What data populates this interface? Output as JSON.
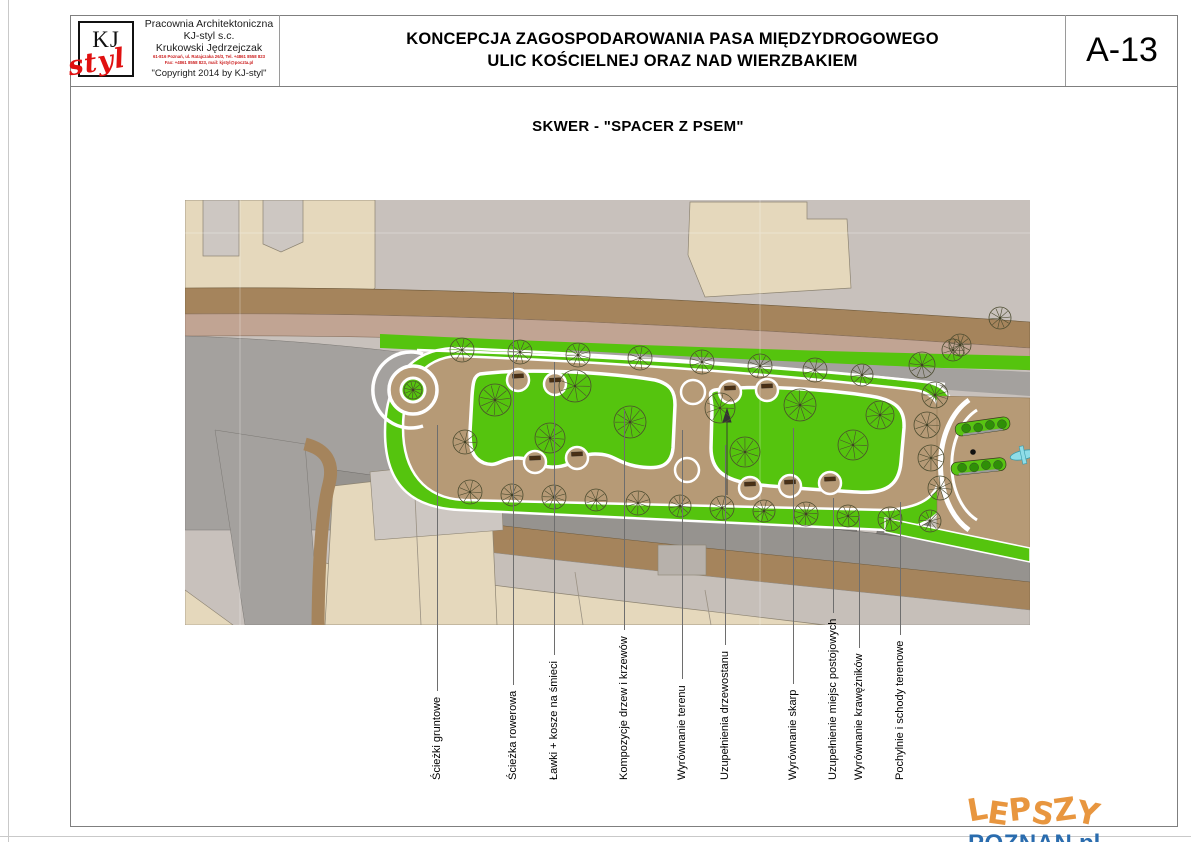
{
  "sheet": {
    "number": "A-13"
  },
  "title_block": {
    "logo_kj": "KJ",
    "logo_styl": "styl",
    "company_line1": "Pracownia Architektoniczna",
    "company_line2": "KJ-styl s.c.",
    "company_line3": "Krukowski Jędrzejczak",
    "address_line1": "61-816 Poznań, ul. Ratajczaka 26/3, Tel. +4861 8558 823",
    "address_line2": "Fax: +4861 8558 823, mail: kjstyl@poczta.pl",
    "copyright": "\"Copyright 2014 by KJ-styl\""
  },
  "header": {
    "title_line1": "KONCEPCJA ZAGOSPODAROWANIA PASA MIĘDZYDROGOWEGO",
    "title_line2": "ULIC KOŚCIELNEJ ORAZ NAD WIERZBAKIEM"
  },
  "drawing": {
    "subtitle": "SKWER - \"SPACER Z PSEM\""
  },
  "annotations": [
    {
      "label": "Ścieżki gruntowe",
      "x": 437,
      "top": 425
    },
    {
      "label": "Ścieżka rowerowa",
      "x": 513,
      "top": 292
    },
    {
      "label": "Ławki + kosze na śmieci",
      "x": 554,
      "top": 362
    },
    {
      "label": "Kompozycje drzew i krzewów",
      "x": 624,
      "top": 410
    },
    {
      "label": "Wyrównanie terenu",
      "x": 682,
      "top": 430
    },
    {
      "label": "Uzupełnienia drzewostanu",
      "x": 725,
      "top": 445
    },
    {
      "label": "Wyrównanie skarp",
      "x": 793,
      "top": 428
    },
    {
      "label": "Uzupełnienie miejsc postojowych",
      "x": 833,
      "top": 498
    },
    {
      "label": "Wyrównanie krawężników",
      "x": 859,
      "top": 516
    },
    {
      "label": "Pochylnie i schody terenowe",
      "x": 900,
      "top": 502
    }
  ],
  "watermark": {
    "word1": "LEPSZY",
    "word2": "POZNAN",
    "word3": ".pl",
    "color1": "#e8963f",
    "color2": "#2a6cae"
  },
  "plan": {
    "colors": {
      "background_gray": "#c8c1bc",
      "building_beige": "#e5d8bc",
      "building_gray": "#cdc7c2",
      "sidewalk_dark_brown": "#a5845c",
      "sidewalk_light_brown": "#c1a493",
      "road_gray": "#a4a19e",
      "lower_road_gray": "#96938f",
      "parking_bay_gray": "#7f7c79",
      "lawn_green": "#55c40e",
      "shrub_green": "#2f8f07",
      "path_brown": "#b69a76",
      "path_edge_white": "#ffffff",
      "tree_outline": "#4b4b2f",
      "bench_brown": "#4a3014",
      "fountain_cyan": "#8fdde8",
      "light_gray_strip": "#c6bfb9"
    },
    "trees": [
      [
        277,
        150,
        12
      ],
      [
        335,
        152,
        12
      ],
      [
        393,
        155,
        12
      ],
      [
        455,
        158,
        12
      ],
      [
        517,
        162,
        12
      ],
      [
        575,
        166,
        12
      ],
      [
        630,
        170,
        12
      ],
      [
        677,
        175,
        11
      ],
      [
        310,
        200,
        16
      ],
      [
        390,
        186,
        16
      ],
      [
        365,
        238,
        15
      ],
      [
        445,
        222,
        16
      ],
      [
        535,
        208,
        15
      ],
      [
        560,
        252,
        15
      ],
      [
        615,
        205,
        16
      ],
      [
        668,
        245,
        15
      ],
      [
        695,
        215,
        14
      ],
      [
        228,
        190,
        9
      ],
      [
        280,
        242,
        12
      ],
      [
        737,
        165,
        13
      ],
      [
        750,
        195,
        13
      ],
      [
        742,
        225,
        13
      ],
      [
        746,
        258,
        13
      ],
      [
        755,
        288,
        12
      ],
      [
        768,
        150,
        11
      ],
      [
        815,
        118,
        11
      ],
      [
        775,
        145,
        11
      ],
      [
        285,
        292,
        12
      ],
      [
        327,
        295,
        11
      ],
      [
        369,
        297,
        12
      ],
      [
        411,
        300,
        11
      ],
      [
        453,
        303,
        12
      ],
      [
        495,
        306,
        11
      ],
      [
        537,
        308,
        12
      ],
      [
        579,
        311,
        11
      ],
      [
        621,
        314,
        12
      ],
      [
        663,
        316,
        11
      ],
      [
        705,
        319,
        12
      ],
      [
        745,
        321,
        11
      ]
    ],
    "benches": [
      [
        333,
        176,
        -3
      ],
      [
        370,
        180,
        -3
      ],
      [
        545,
        188,
        -2
      ],
      [
        582,
        186,
        -2
      ],
      [
        350,
        258,
        -2
      ],
      [
        392,
        254,
        -2
      ],
      [
        565,
        284,
        -2
      ],
      [
        605,
        282,
        -2
      ],
      [
        645,
        279,
        -2
      ]
    ],
    "parking_bay_x": [
      268,
      338,
      408,
      478,
      550,
      622,
      694
    ]
  }
}
